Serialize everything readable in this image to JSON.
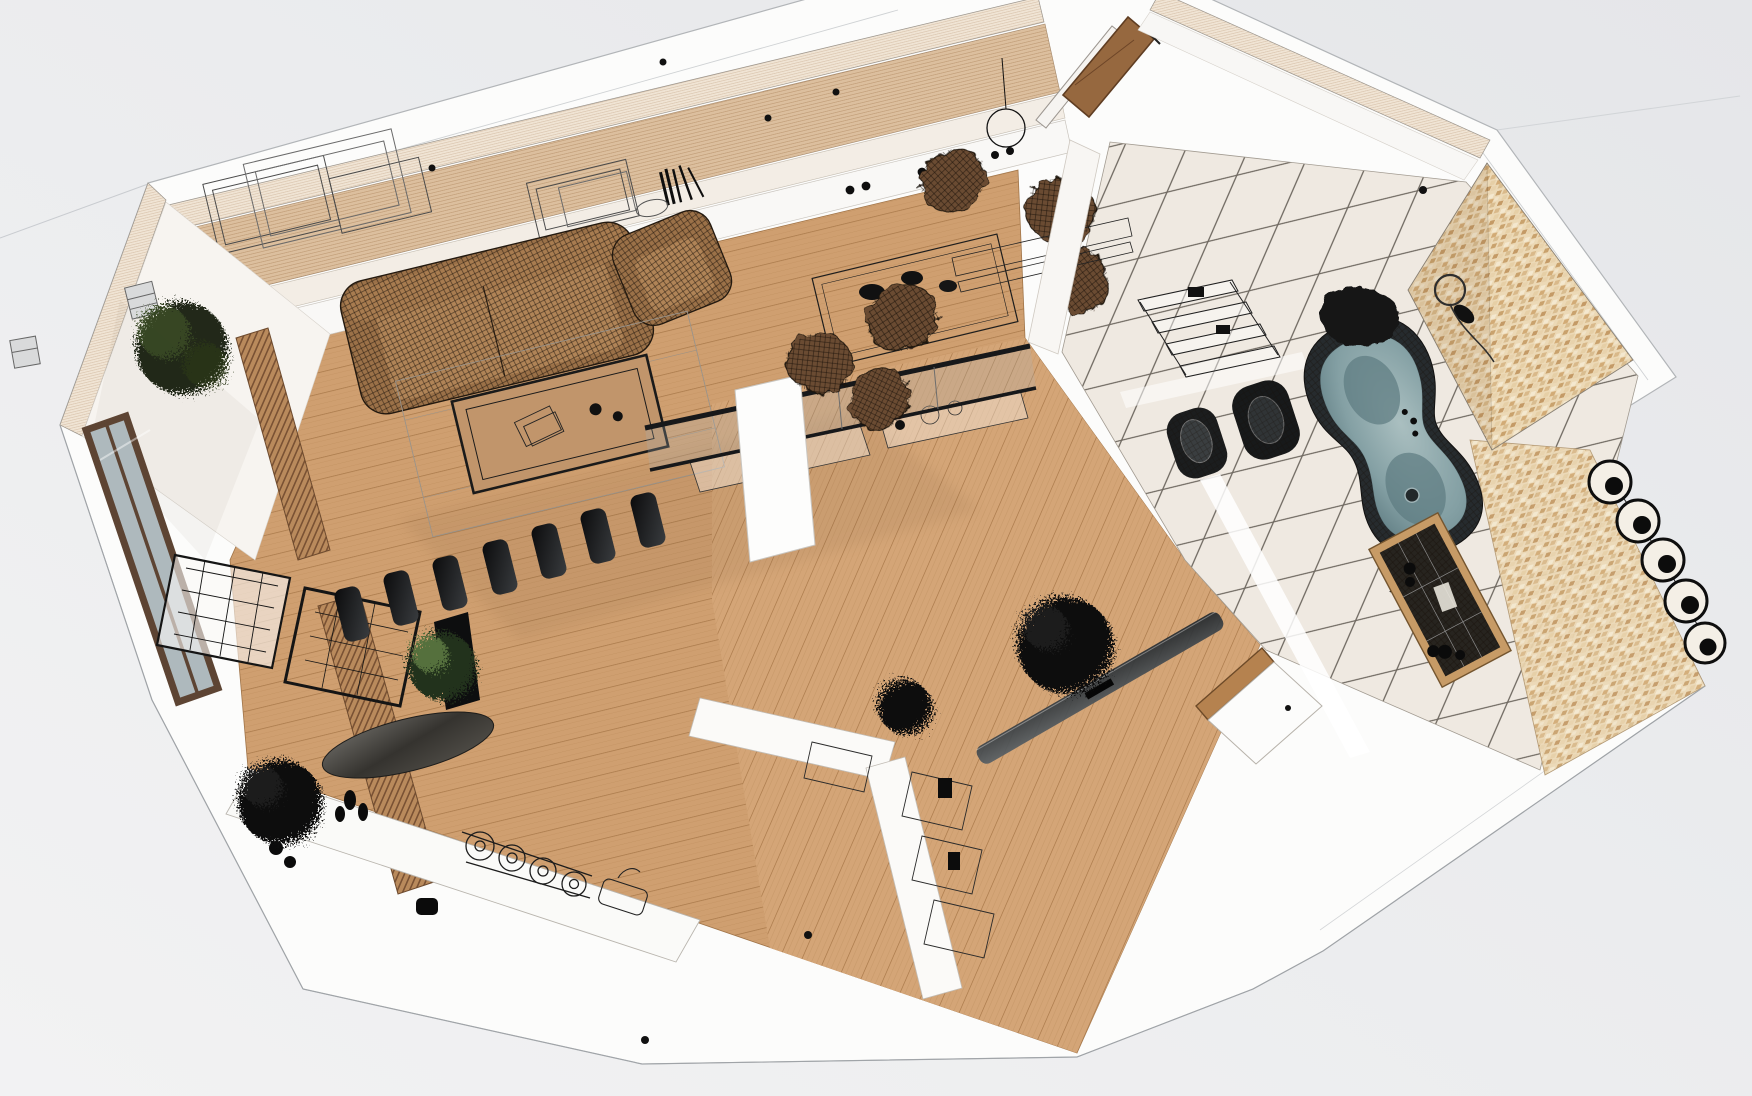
{
  "scene": {
    "label": "3D wireframe cutaway render of a furnished apartment floor plan viewed from above",
    "style": "hybrid photorealistic render with black wireframe mesh furniture",
    "rotation_deg": -13.5,
    "background_color": "#e9eaec"
  },
  "palette": {
    "wood_floor": "#cf9f70",
    "wood_floor_lines": "#a9794a",
    "wall_cut_top": "#f0e4d4",
    "wall_face_panel": "#dcbf9e",
    "wall_white": "#f8f7f5",
    "slab_white": "#fcfcfb",
    "tile_floor": "#efe9e1",
    "tile_grout": "#6d675f",
    "mosaic": "#ecd9b6",
    "glass": "#aeb9bd",
    "fixture_black": "#1b1d1e",
    "upholstery_tan": "#a87c50",
    "chair_mesh_brown": "#6b4c30",
    "tub_basin": "#8aa4a8",
    "entry_door_wood": "#96683f",
    "plant_dark": "#101010",
    "plant_green": "#5e7a45"
  },
  "rooms": [
    {
      "id": "living",
      "label": "Living room with wireframe sofa, armchair and coffee table"
    },
    {
      "id": "dining",
      "label": "Dining area with mesh shell chairs and glass table"
    },
    {
      "id": "kitchen",
      "label": "Kitchen strip with wireframe counters, hob and bar stools"
    },
    {
      "id": "hall",
      "label": "Hallway wing with glass partition and sliding glass door"
    },
    {
      "id": "bathroom",
      "label": "Bathroom with freestanding tub, toilet, bidet and mosaic shower wall"
    },
    {
      "id": "balcony",
      "label": "Balcony with wood-framed glazing, slat screen and plants"
    }
  ],
  "furniture": {
    "sofa": {
      "label": "wireframe three-seat sofa",
      "color": "#a87c50"
    },
    "armchair": {
      "label": "wireframe armchair",
      "color": "#a87c50"
    },
    "coffee_table": {
      "label": "coffee table with wireframe books on rug"
    },
    "media_stools": {
      "label": "row of glossy black bar stools at media counter"
    },
    "tv_panel": {
      "label": "black TV panel on stand"
    },
    "oval_table": {
      "label": "dark oval table top"
    },
    "dining_set": {
      "label": "glass dining table with six mesh shell chairs"
    },
    "pendant_lamp": {
      "label": "wireframe pendant lamp ring"
    },
    "sideboard": {
      "label": "long white sideboard with black knobs"
    },
    "picture_frames": {
      "label": "wireframe picture frames leaning on wall panel"
    },
    "books": {
      "label": "books leaning on wall ledge"
    },
    "entry_door": {
      "label": "open wooden entry door"
    },
    "glass_partition": {
      "label": "glass partition with black top rail"
    },
    "glass_door": {
      "label": "sliding glass door seen edge-on"
    },
    "island_column": {
      "label": "white island column"
    },
    "kitchen_counter": {
      "label": "wireframe kitchen counter with gas hob and sink"
    },
    "stairs": {
      "label": "wireframe staircase"
    },
    "desk": {
      "label": "wireframe desk frames"
    },
    "balcony_doors": {
      "label": "wood framed balcony glazing"
    },
    "slat_screen": {
      "label": "wooden slat screen"
    },
    "wall_sconces": {
      "label": "wireframe wall sconce boxes"
    },
    "plants": {
      "label": "scribbled indoor plants"
    },
    "bathtub": {
      "label": "freestanding wireframe bathtub with slate blue basin"
    },
    "toilet": {
      "label": "black mesh toilet"
    },
    "bidet": {
      "label": "black mesh bidet"
    },
    "shelf_rack": {
      "label": "wireframe bathroom shelf rack"
    },
    "shower_set": {
      "label": "chrome shower set on mosaic wall"
    },
    "hair_dryer": {
      "label": "hair dryer on tile floor"
    },
    "bathroom_door": {
      "label": "open white bathroom door with wood threshold"
    },
    "vanity_dresser": {
      "label": "wooden vanity dresser with wireframe top"
    },
    "ring_decor": {
      "label": "chain of round decor rings on mosaic strip"
    },
    "mosaic_wall": {
      "label": "mosaic shower wall wedge"
    },
    "storage_units": {
      "label": "wireframe storage units along hall wall"
    },
    "ceiling_spots": {
      "label": "black ceiling spot dots"
    }
  }
}
